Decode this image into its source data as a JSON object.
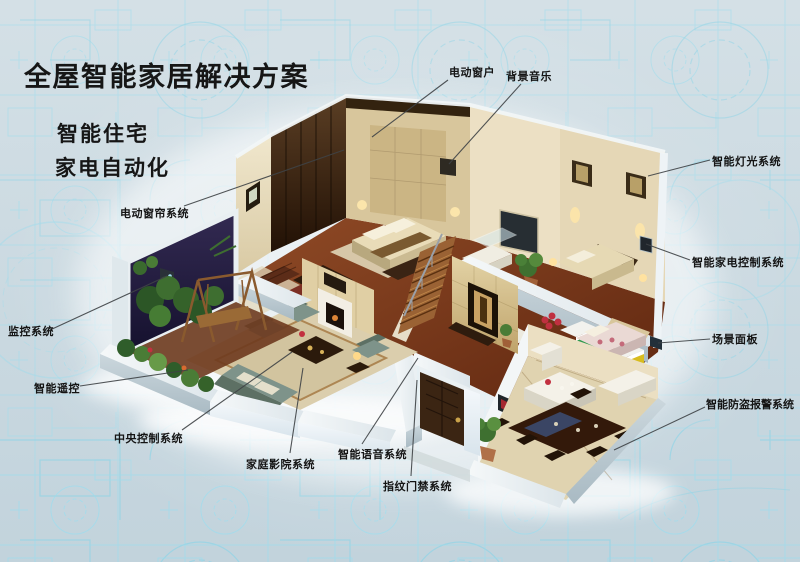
{
  "title": "全屋智能家居解决方案",
  "subtitles": [
    "智能住宅",
    "家电自动化"
  ],
  "callouts": [
    {
      "id": "electric-window",
      "label": "电动窗户"
    },
    {
      "id": "background-music",
      "label": "背景音乐"
    },
    {
      "id": "smart-lighting",
      "label": "智能灯光系统"
    },
    {
      "id": "smart-appliance-control",
      "label": "智能家电控制系统"
    },
    {
      "id": "scene-panel",
      "label": "场景面板"
    },
    {
      "id": "burglar-alarm",
      "label": "智能防盗报警系统"
    },
    {
      "id": "electric-curtain",
      "label": "电动窗帘系统"
    },
    {
      "id": "monitoring",
      "label": "监控系统"
    },
    {
      "id": "smart-remote",
      "label": "智能遥控"
    },
    {
      "id": "central-control",
      "label": "中央控制系统"
    },
    {
      "id": "home-theater",
      "label": "家庭影院系统"
    },
    {
      "id": "voice-system",
      "label": "智能语音系统"
    },
    {
      "id": "fingerprint-access",
      "label": "指纹门禁系统"
    }
  ],
  "colors": {
    "background": "#c9d8e0",
    "blueprint_line": "#9fdcec",
    "label_text": "#141414",
    "leader_line": "#3f4346"
  }
}
